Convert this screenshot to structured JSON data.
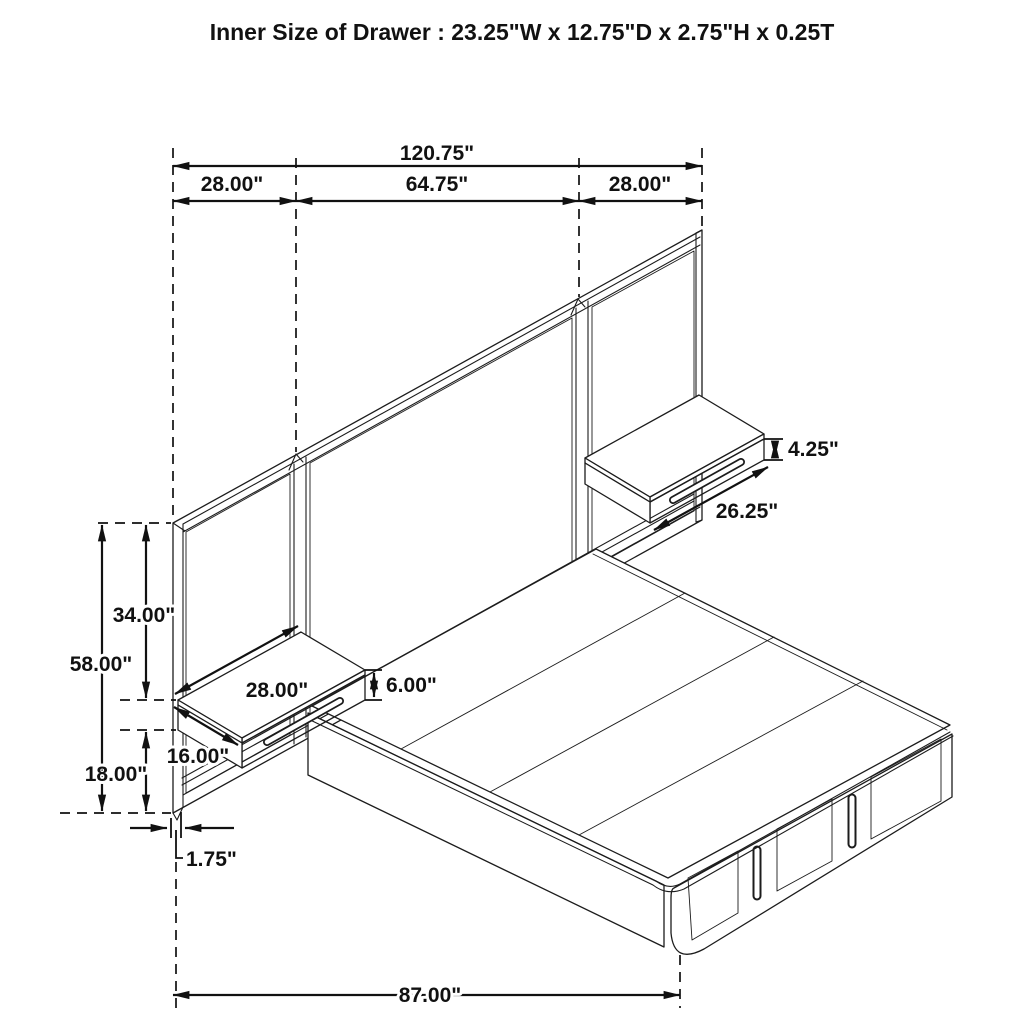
{
  "title": "Inner Size of Drawer : 23.25\"W x 12.75\"D x 2.75\"H x 0.25T",
  "dims": {
    "overall_width": "120.75\"",
    "section_left": "28.00\"",
    "section_middle": "64.75\"",
    "section_right": "28.00\"",
    "panel_height": "58.00\"",
    "top_to_nightstand": "34.00\"",
    "below_nightstand": "18.00\"",
    "panel_thickness": "1.75\"",
    "bed_length": "87.00\"",
    "nightstand_left_width": "28.00\"",
    "nightstand_left_depth": "16.00\"",
    "nightstand_left_height": "6.00\"",
    "nightstand_right_width": "26.25\"",
    "nightstand_right_height": "4.25\""
  }
}
